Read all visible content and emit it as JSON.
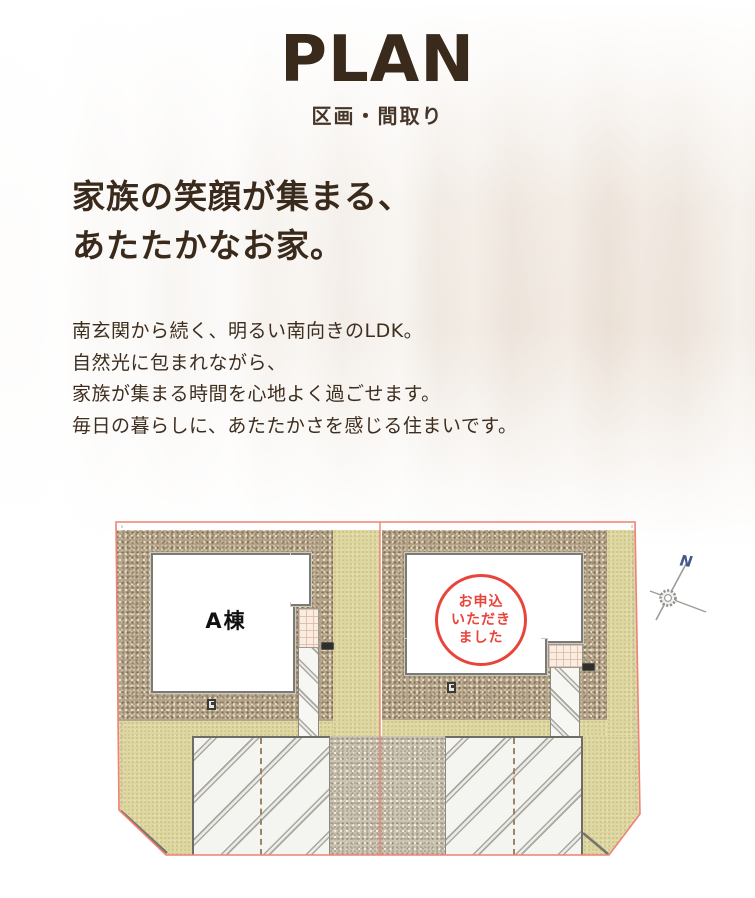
{
  "header": {
    "title": "PLAN",
    "subtitle": "区画・間取り"
  },
  "intro": {
    "heading_lines": [
      "家族の笑顔が集まる、",
      "あたたかなお家。"
    ],
    "body_lines": [
      "南玄関から続く、明るい南向きのLDK。",
      "自然光に包まれながら、",
      "家族が集まる時間を心地よく過ごせます。",
      "毎日の暮らしに、あたたかさを感じる住まいです。"
    ]
  },
  "site_plan": {
    "lot_a": {
      "label": "A棟"
    },
    "lot_b": {
      "stamp_lines": [
        "お申込",
        "いただき",
        "ました"
      ]
    },
    "compass": {
      "label": "N"
    },
    "colors": {
      "boundary_line": "#ef8274",
      "stamp_red": "#e8443a",
      "gravel": "#b3a287",
      "gravel_light": "#ccc4b2",
      "lawn": "#ded6a0",
      "heading_text": "#3a2a1c",
      "title_text": "#3a2a1b"
    }
  }
}
